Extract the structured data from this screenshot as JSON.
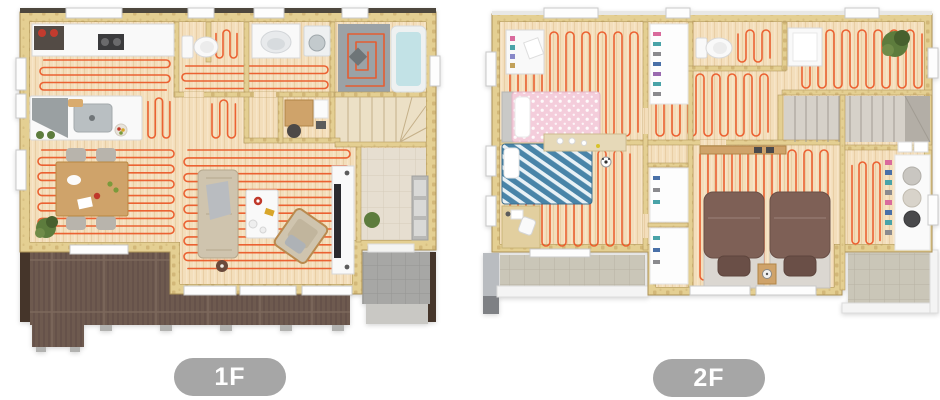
{
  "page": {
    "background": "#ffffff",
    "kind": "house-floor-plan-rendering",
    "heating": "underfloor-heating-pipes"
  },
  "floors": [
    {
      "id": "1f",
      "label": "1F",
      "rooms": [
        "kitchen",
        "dining",
        "living",
        "toilet",
        "washroom",
        "bathroom",
        "stairs",
        "study-nook",
        "entrance",
        "wood-deck",
        "porch"
      ]
    },
    {
      "id": "2f",
      "label": "2F",
      "rooms": [
        "kids-bedroom-1",
        "kids-bedroom-2",
        "hall",
        "toilet",
        "closet",
        "free-space",
        "stairs",
        "master-bedroom",
        "walk-in-closet",
        "balcony-left",
        "balcony-right"
      ]
    }
  ],
  "colors": {
    "bg": "#ffffff",
    "pipe": "#ea5726",
    "wall": "#e4cf92",
    "wall_tick": "#c2a363",
    "wood_floor": "#f3debb",
    "wood_grain": "#e6cba0",
    "deck": "#6e5a50",
    "deck_line": "#5d4a41",
    "balcony_tile": "#cac6b8",
    "porch_tile": "#a7a7a5",
    "entrance_tile": "#e6ded0",
    "bath_floor": "#9ba2a6",
    "tub_water": "#c2e2e6",
    "stairs_1f": "#ece0c6",
    "stairs_2f": "#d6d1c9",
    "sofa": "#cfc4ae",
    "wood_furniture": "#cfa36a",
    "pink_bed": "#f4cddb",
    "blue_bed": "#4a84a8",
    "master_duvet": "#7e6157",
    "plant": "#5d7c3c",
    "badge_bg": "#a6a6a6",
    "badge_text": "#ffffff"
  }
}
